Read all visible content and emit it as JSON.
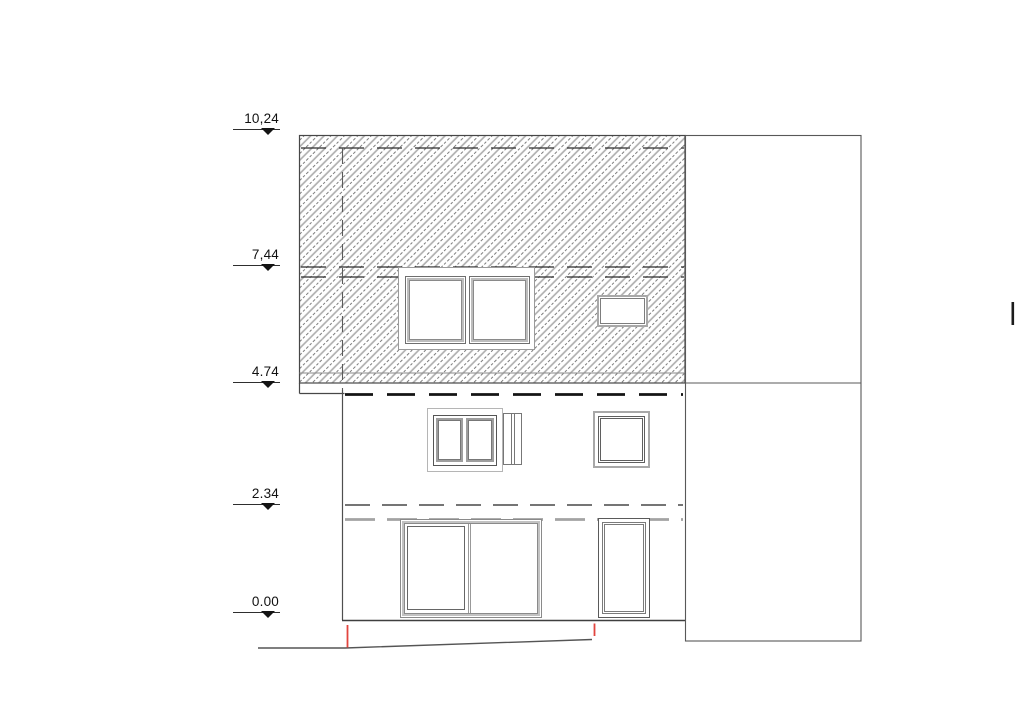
{
  "drawing": {
    "levels": [
      {
        "label": "10,24"
      },
      {
        "label": "7,44"
      },
      {
        "label": "4.74"
      },
      {
        "label": "2.34"
      },
      {
        "label": "0.00"
      }
    ],
    "colors": {
      "line": "#4a4a4a",
      "hatch_gray": "#b0b0b0",
      "frame_gray": "#a8a8a8",
      "heavy_dash_black": "#141414",
      "heavy_dash_gray": "#a3a3a3",
      "marker_red": "#e2453e"
    }
  }
}
